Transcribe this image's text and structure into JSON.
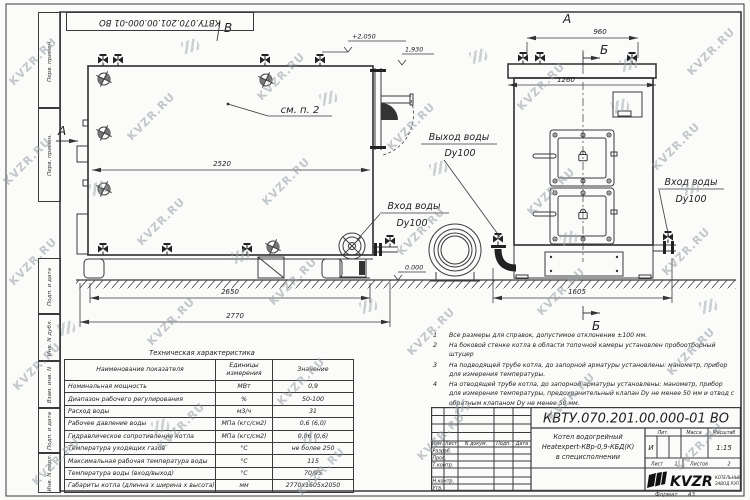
{
  "watermark": {
    "text": "KVZR.RU"
  },
  "top_stamp": {
    "doc_number": "КВТУ.070.201.00.000-01 ВО"
  },
  "side_column": {
    "boxes": [
      "Перв. примен.",
      "Перв. примен.",
      "Подп. и дата",
      "Инв. N дубл.",
      "Взам. инв. N",
      "Подп. и дата",
      "Инв. N подл."
    ]
  },
  "drawing": {
    "view_labels": {
      "b_top": "В",
      "a_side": "А",
      "a_front": "А",
      "b_front_top": "Б",
      "b_front_bottom": "Б"
    },
    "callouts": {
      "see_item": "см. п. 2",
      "outlet_line1": "Выход воды",
      "outlet_line2": "Dy100",
      "inlet_side_line1": "Вход воды",
      "inlet_side_line2": "Dy100",
      "inlet_right_line1": "Вход воды",
      "inlet_right_line2": "Dy100"
    },
    "dimensions": {
      "d2520": "2520",
      "d2650": "2650",
      "d2770": "2770",
      "d960": "960",
      "d1260": "1260",
      "d1605": "1605"
    },
    "elevations": {
      "top": "+2,050",
      "outlet": "1,930",
      "ground": "0.000"
    }
  },
  "spec_table": {
    "title": "Техническая характеристика",
    "headers": [
      "Наименование показателя",
      "Единицы измерения",
      "Значение"
    ],
    "rows": [
      [
        "Номинальная мощность",
        "МВт",
        "0,9"
      ],
      [
        "Диапазон рабочего регулирования",
        "%",
        "50-100"
      ],
      [
        "Расход воды",
        "м3/ч",
        "31"
      ],
      [
        "Рабочее давление воды",
        "МПа (кгс/см2)",
        "0,6 (6,0)"
      ],
      [
        "Гидравлическое сопротивление котла",
        "МПа (кгс/см2)",
        "0,06 (0,6)"
      ],
      [
        "Температура уходящих газов",
        "°С",
        "не более 250"
      ],
      [
        "Максимальная рабочая температура воды",
        "°С",
        "115"
      ],
      [
        "Температура воды (вход/выход)",
        "°С",
        "70/95"
      ],
      [
        "Габариты котла (длинна х ширина х высота)",
        "мм",
        "2770х1605х2050"
      ]
    ]
  },
  "notes": {
    "items": [
      {
        "num": "1",
        "text": "Все размеры для справок, допустимое отклонение ±100 мм."
      },
      {
        "num": "2",
        "text": "На боковой стенке котла в области топочной камеры установлен пробоотборный штуцер"
      },
      {
        "num": "3",
        "text": "На подводящей трубе котла, до запорной арматуры установлены: манометр, прибор для измерения температуры."
      },
      {
        "num": "4",
        "text": "На отводящей трубе котла, до запорной арматуры установлены: манометр, прибор для измерения температуры, предохранительный клапан Dу не менее 50 мм и отвод с обратным клапаном Dу не менее 50 мм."
      }
    ]
  },
  "title_block": {
    "doc_number": "КВТУ.070.201.00.000-01 ВО",
    "product_title_line1": "Котел водогрейный",
    "product_title_line2": "Heatexpert-КВр-0,9-КБД(К)",
    "product_title_line3": "в специсполнении",
    "col_headers": [
      "Изм.",
      "Лист",
      "N докум.",
      "Подп.",
      "Дата"
    ],
    "row_labels": [
      "Разраб.",
      "Пров.",
      "Т.контр.",
      "Н.контр.",
      "Утв."
    ],
    "lit_label": "Лит.",
    "mass_label": "Масса",
    "scale_label": "Масштаб",
    "lit_value": "И",
    "scale_value": "1:15",
    "sheet_label": "Лист",
    "sheet_value": "1",
    "sheets_label": "Листов",
    "sheets_value": "2",
    "company_logo": "KVZR",
    "company_line1": "КОТЕЛЬНЫЙ",
    "company_line2": "ЗАВОД РЭП",
    "format_label": "Формат",
    "format_value": "А3"
  }
}
